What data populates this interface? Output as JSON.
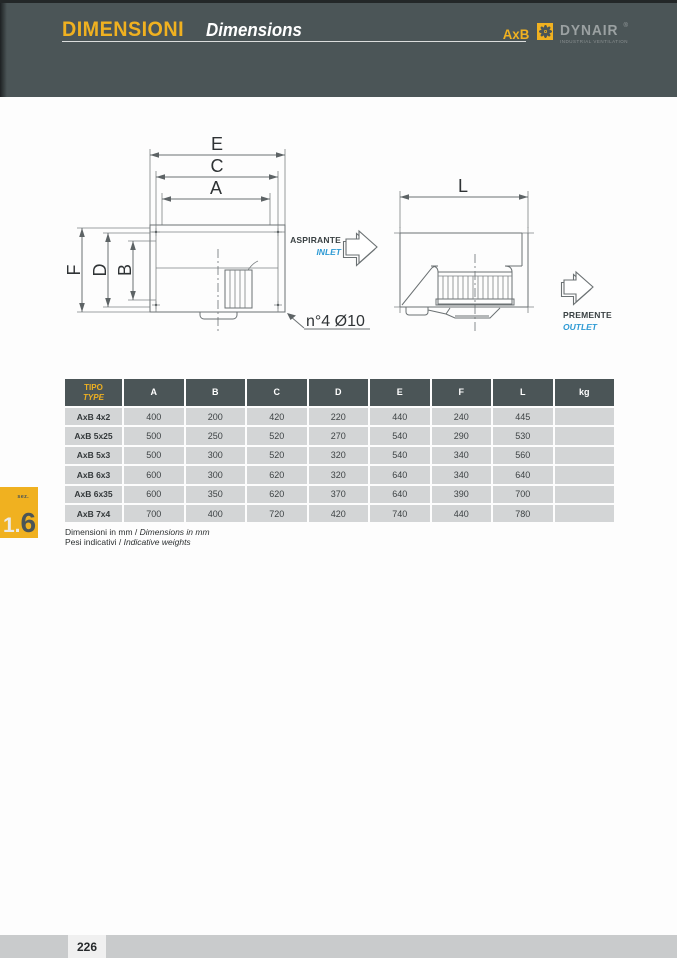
{
  "header": {
    "title_it": "DIMENSIONI",
    "title_en": "Dimensions",
    "model": "AxB",
    "brand": "DYNAIR",
    "brand_reg": "®",
    "brand_tagline": "INDUSTRIAL VENTILATION"
  },
  "icons": {
    "brand_fan": "fan-icon",
    "inlet_arrow": "arrow-right-icon",
    "outlet_arrow": "arrow-right-icon"
  },
  "colors": {
    "accent_yellow": "#f0b120",
    "panel_dark": "#4b5557",
    "row_gray": "#d3d5d6",
    "footer_gray": "#c9cbcc",
    "inlet_blue": "#2e9ad4",
    "line_gray": "#6b7173"
  },
  "drawing": {
    "dim_a": "A",
    "dim_b": "B",
    "dim_c": "C",
    "dim_d": "D",
    "dim_e": "E",
    "dim_f": "F",
    "dim_l": "L",
    "hole_note": "n°4 Ø10",
    "inlet_it": "ASPIRANTE",
    "inlet_en": "INLET",
    "outlet_it": "PREMENTE",
    "outlet_en": "OUTLET"
  },
  "table": {
    "col_tipo_it": "TIPO",
    "col_tipo_en": "TYPE",
    "columns": [
      "A",
      "B",
      "C",
      "D",
      "E",
      "F",
      "L",
      "kg"
    ],
    "rows": [
      {
        "tipo": "AxB 4x2",
        "values": [
          "400",
          "200",
          "420",
          "220",
          "440",
          "240",
          "445",
          ""
        ]
      },
      {
        "tipo": "AxB 5x25",
        "values": [
          "500",
          "250",
          "520",
          "270",
          "540",
          "290",
          "530",
          ""
        ]
      },
      {
        "tipo": "AxB 5x3",
        "values": [
          "500",
          "300",
          "520",
          "320",
          "540",
          "340",
          "560",
          ""
        ]
      },
      {
        "tipo": "AxB 6x3",
        "values": [
          "600",
          "300",
          "620",
          "320",
          "640",
          "340",
          "640",
          ""
        ]
      },
      {
        "tipo": "AxB 6x35",
        "values": [
          "600",
          "350",
          "620",
          "370",
          "640",
          "390",
          "700",
          ""
        ]
      },
      {
        "tipo": "AxB 7x4",
        "values": [
          "700",
          "400",
          "720",
          "420",
          "740",
          "440",
          "780",
          ""
        ]
      }
    ]
  },
  "footnotes": {
    "l1_it": "Dimensioni in mm / ",
    "l1_en": "Dimensions in mm",
    "l2_it": "Pesi indicativi / ",
    "l2_en": "Indicative weights"
  },
  "section_tab": {
    "label": "sez.",
    "num_a": "1.",
    "num_b": "6"
  },
  "footer": {
    "page": "226"
  }
}
